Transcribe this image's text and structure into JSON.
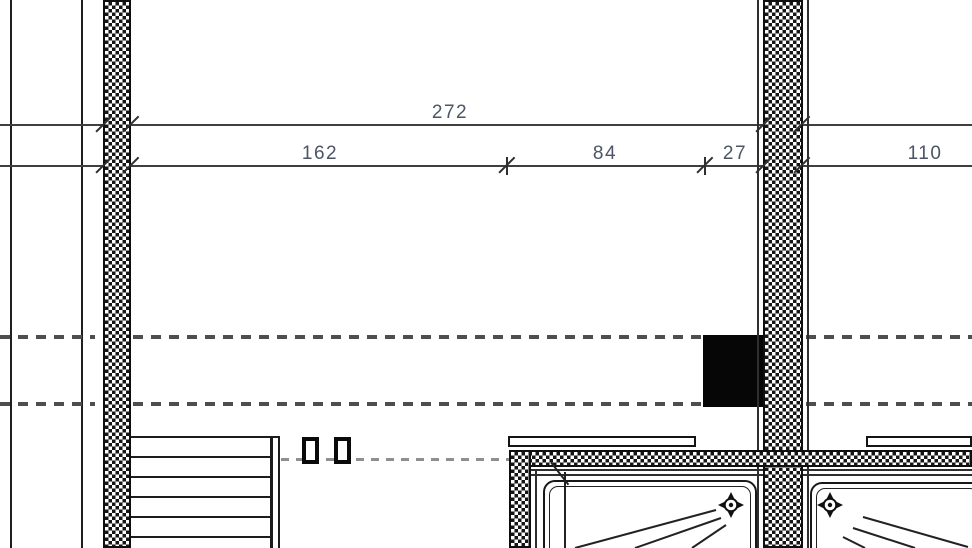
{
  "plan": {
    "dimension_labels": {
      "total": "272",
      "seg_left": "162",
      "seg_mid": "84",
      "seg_small": "27",
      "seg_right": "110"
    },
    "icons": {
      "drain": "crosshair-drain-icon"
    },
    "colors": {
      "background": "#ffffff",
      "linework": "#1c1c1c",
      "dimension_line": "#3f3f3f",
      "dimension_text": "#4b5563",
      "axis_dash": "#4e4e4e",
      "light_dash": "#8f8f8f",
      "chimney_fill": "#060606"
    }
  }
}
